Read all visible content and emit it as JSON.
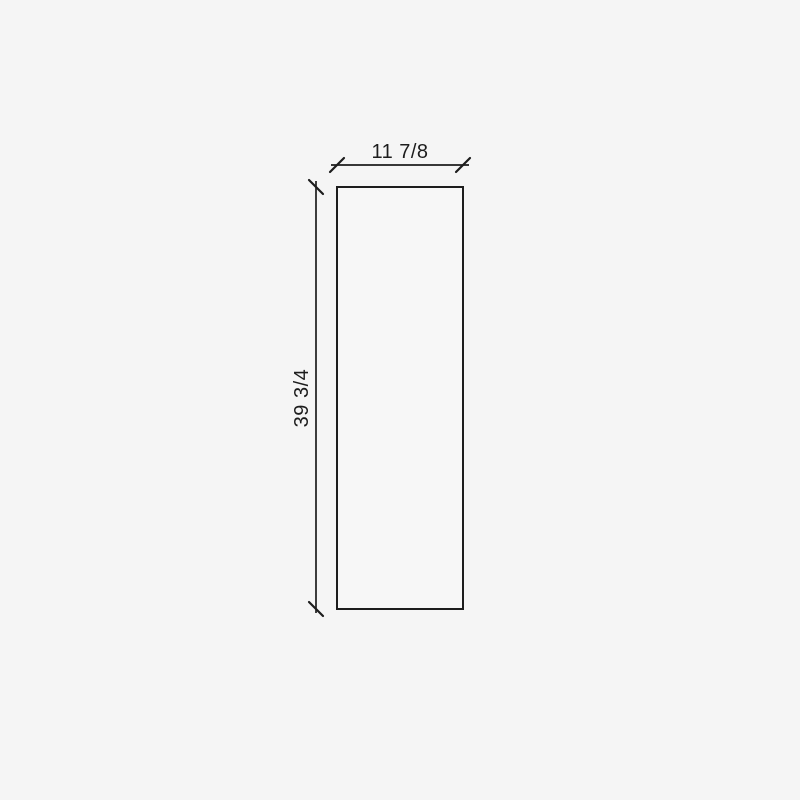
{
  "diagram": {
    "type": "panel-dimension-drawing",
    "shape": "rectangle",
    "width_dimension": {
      "label": "11 7/8"
    },
    "height_dimension": {
      "label": "39 3/4"
    },
    "colors": {
      "background": "#f5f5f5",
      "line": "#1d1d1d",
      "panel_fill": "#f7f7f7"
    }
  }
}
